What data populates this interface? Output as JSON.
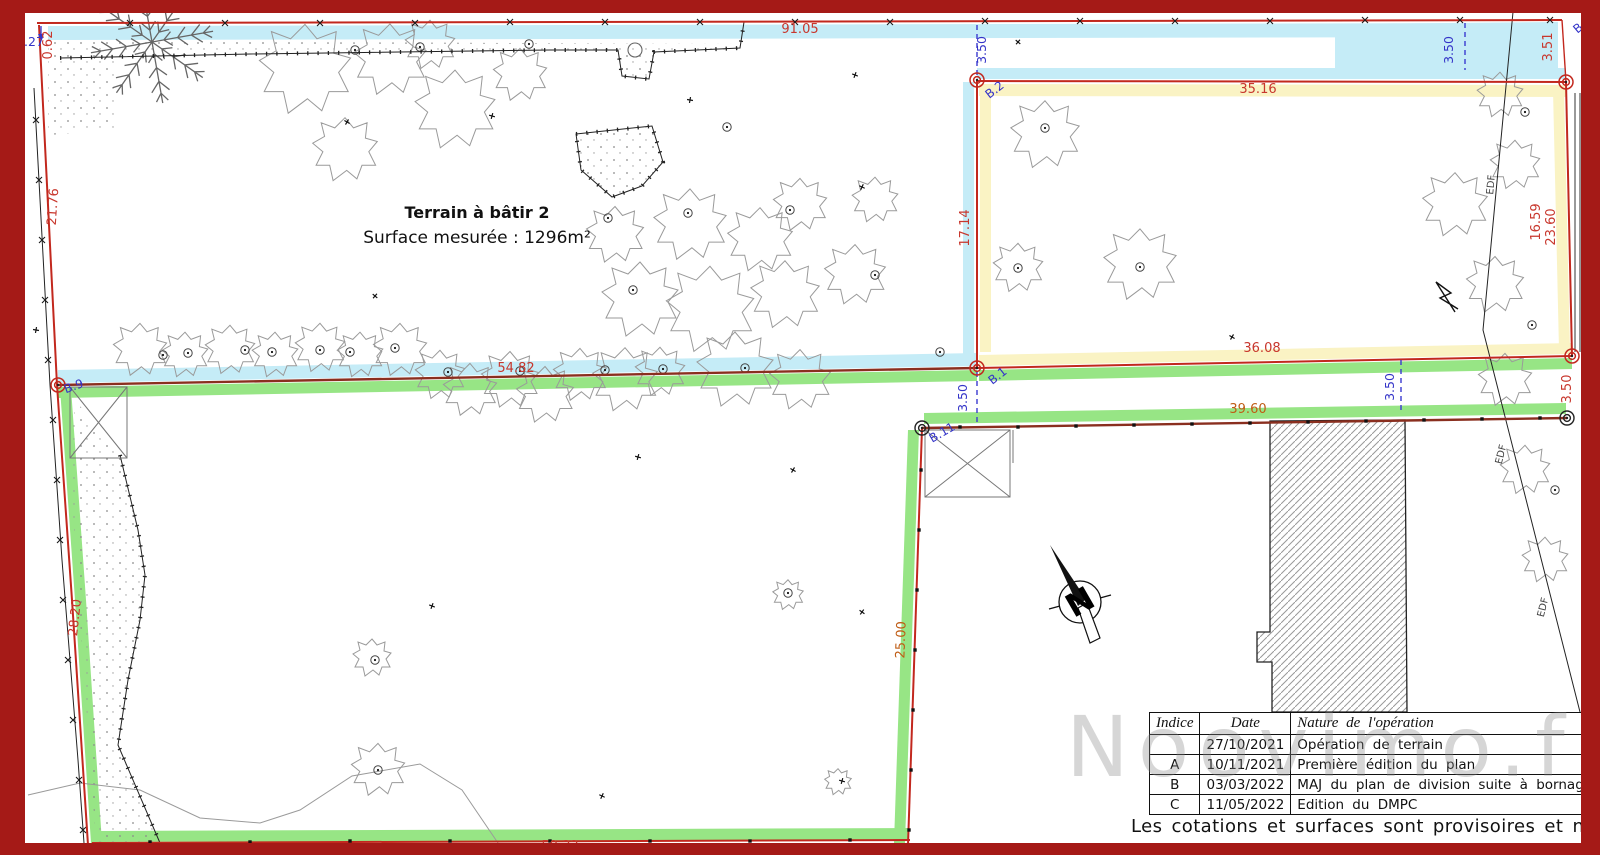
{
  "frame_color": "#a51a17",
  "plan": {
    "title": "Terrain à bâtir 2",
    "surface": "Surface mesurée : 1296m²",
    "note": "Les cotations et surfaces sont provisoires et ne seront défi",
    "watermark": "Noovimo.fr",
    "north": "N",
    "edf": "EDF"
  },
  "dims": {
    "top": "91.05",
    "mid": "54.82",
    "parcel_top": "35.16",
    "parcel_mid": "36.08",
    "parcel_left": "17.14",
    "v351": "3.51",
    "v062": "0.62",
    "v2176": "21.76",
    "v2820": "28.20",
    "v1659": "16.59",
    "v2360": "23.60",
    "bottom": "59.32",
    "offset": "3.50",
    "fence_east": "39.60",
    "fence_south": "25.00",
    "b87": "8.7",
    "b027": "0.27"
  },
  "points": {
    "b2": "B.2",
    "b1": "B.1",
    "b11": "B.11",
    "b9": "B.9",
    "bcut": "B."
  },
  "table": {
    "headers": [
      "Indice",
      "Date",
      "Nature de l'opération"
    ],
    "rows": [
      {
        "indice": "",
        "date": "27/10/2021",
        "nature": "Opération de terrain"
      },
      {
        "indice": "A",
        "date": "10/11/2021",
        "nature": "Première édition du plan"
      },
      {
        "indice": "B",
        "date": "03/03/2022",
        "nature": "MAJ du plan de division suite à bornage contrad"
      },
      {
        "indice": "C",
        "date": "11/05/2022",
        "nature": "Edition du DMPC"
      }
    ]
  },
  "colors": {
    "red": "#c8372d",
    "orange": "#bf5c14",
    "blue": "#3434c8",
    "cyan": "#c5ecf7",
    "yellow": "#faf3c4",
    "green": "#97e585",
    "frame": "#a51a17"
  }
}
